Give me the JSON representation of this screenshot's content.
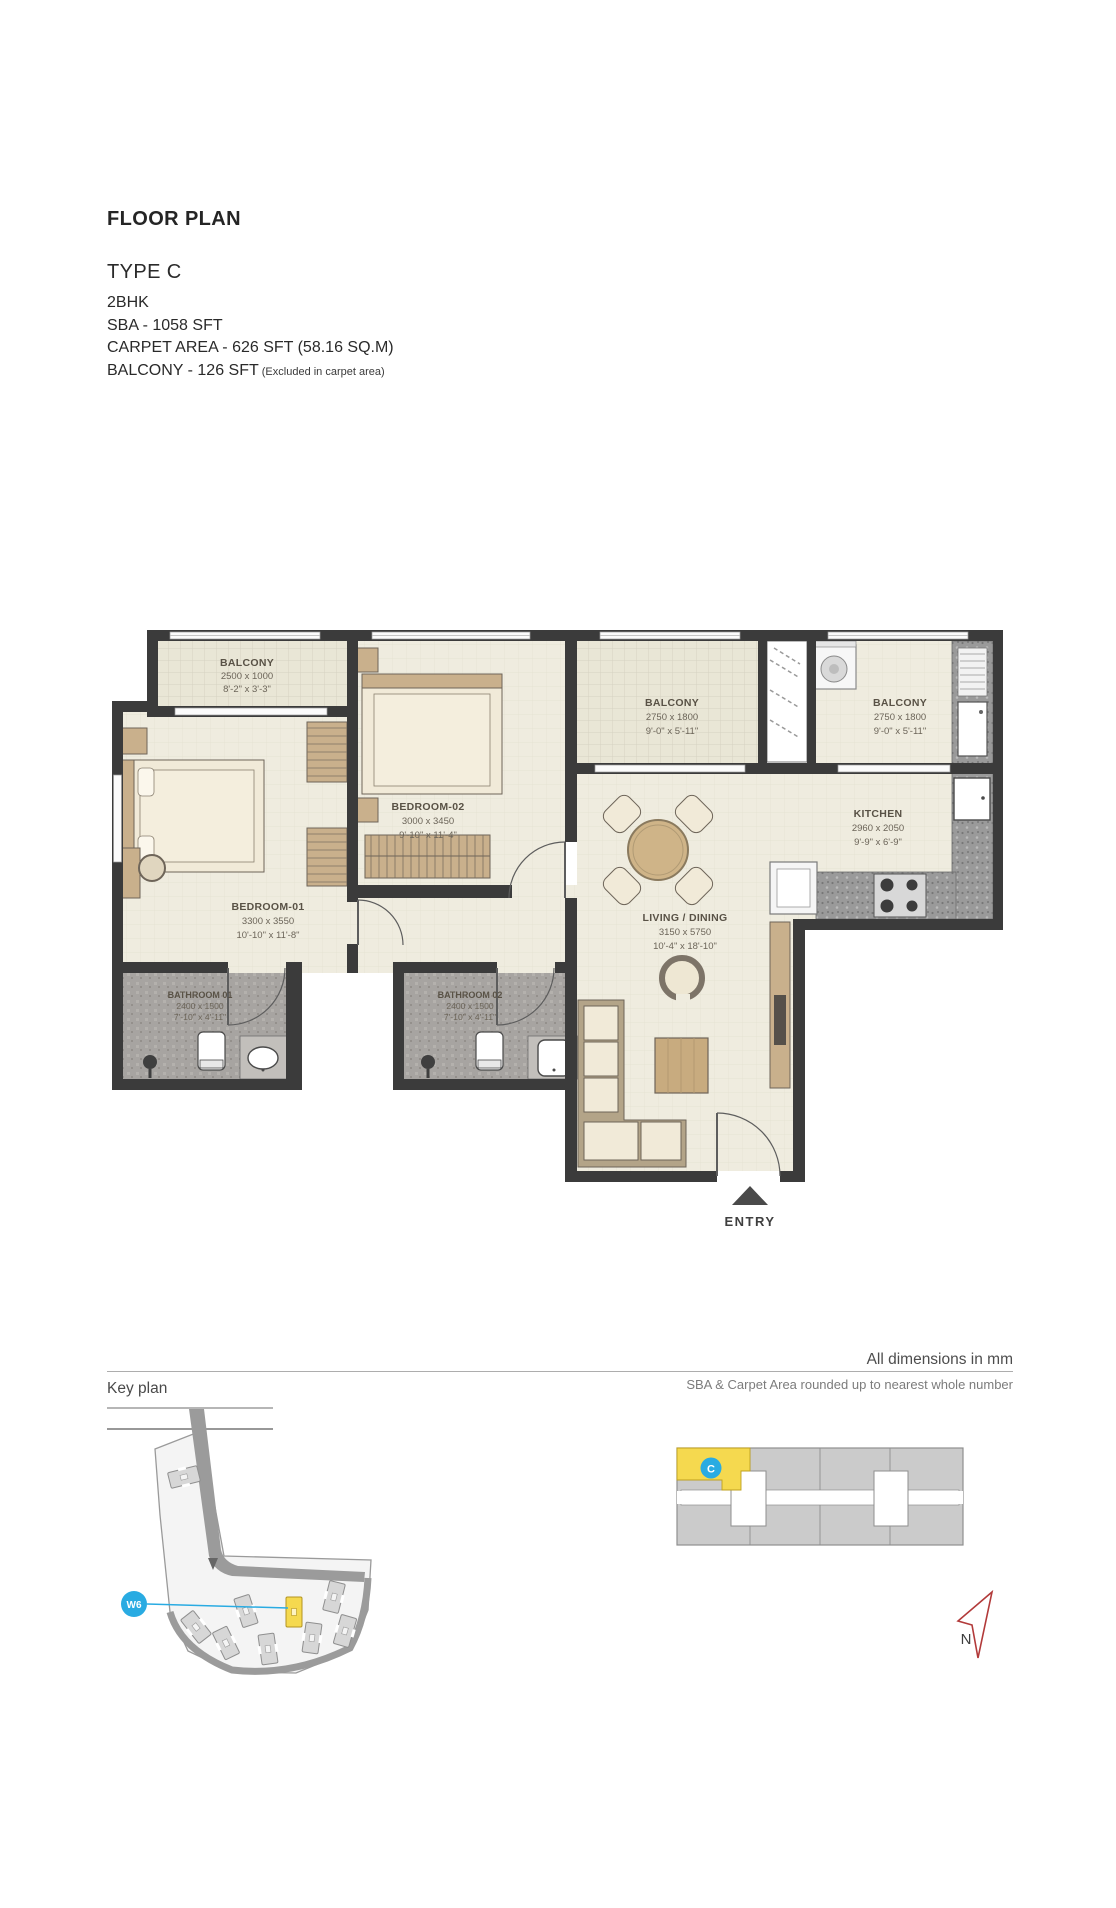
{
  "header": {
    "title": "FLOOR PLAN",
    "type": "TYPE C",
    "config": "2BHK",
    "sba": "SBA - 1058 SFT",
    "carpet": "CARPET AREA - 626 SFT (58.16 SQ.M)",
    "balcony": "BALCONY - 126 SFT",
    "balcony_note": "(Excluded in carpet area)"
  },
  "plan": {
    "rooms": [
      {
        "name": "BALCONY",
        "mm": "2500 x 1000",
        "ft": "8'-2\" x 3'-3\""
      },
      {
        "name": "BEDROOM-02",
        "mm": "3000 x 3450",
        "ft": "9'-10\" x 11'-4\""
      },
      {
        "name": "BALCONY",
        "mm": "2750 x 1800",
        "ft": "9'-0\" x 5'-11\""
      },
      {
        "name": "BALCONY",
        "mm": "2750 x 1800",
        "ft": "9'-0\" x 5'-11\""
      },
      {
        "name": "KITCHEN",
        "mm": "2960 x 2050",
        "ft": "9'-9\" x 6'-9\""
      },
      {
        "name": "BEDROOM-01",
        "mm": "3300 x 3550",
        "ft": "10'-10\" x 11'-8\""
      },
      {
        "name": "BATHROOM 01",
        "mm": "2400 x 1500",
        "ft": "7'-10\" x 4'-11\""
      },
      {
        "name": "BATHROOM 02",
        "mm": "2400 x 1500",
        "ft": "7'-10\" x 4'-11\""
      },
      {
        "name": "LIVING / DINING",
        "mm": "3150 x 5750",
        "ft": "10'-4\" x 18'-10\""
      }
    ],
    "entry_label": "ENTRY"
  },
  "footer": {
    "dims_note": "All dimensions in mm",
    "rounding_note": "SBA & Carpet Area rounded up to nearest whole number",
    "key_plan_label": "Key plan"
  },
  "key_plan": {
    "unit_label": "C",
    "marker_label": "W6",
    "north_label": "N",
    "highlight_color": "#f5d94f",
    "accent_color": "#29abe2"
  }
}
